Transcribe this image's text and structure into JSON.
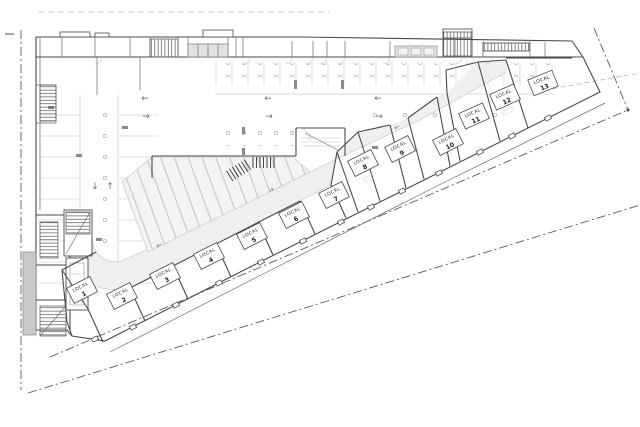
{
  "drawing": {
    "kind": "architectural-floor-plan",
    "units_label_word": "LOCAL"
  },
  "units": [
    {
      "name": "LOCAL",
      "number": "1"
    },
    {
      "name": "LOCAL",
      "number": "2"
    },
    {
      "name": "LOCAL",
      "number": "3"
    },
    {
      "name": "LOCAL",
      "number": "4"
    },
    {
      "name": "LOCAL",
      "number": "5"
    },
    {
      "name": "LOCAL",
      "number": "6"
    },
    {
      "name": "LOCAL",
      "number": "7"
    },
    {
      "name": "LOCAL",
      "number": "8"
    },
    {
      "name": "LOCAL",
      "number": "9"
    },
    {
      "name": "LOCAL",
      "number": "10"
    },
    {
      "name": "LOCAL",
      "number": "11"
    },
    {
      "name": "LOCAL",
      "number": "12"
    },
    {
      "name": "LOCAL",
      "number": "13"
    }
  ],
  "icons": {
    "arrow_left": "←",
    "arrow_right": "→",
    "arrow_up": "↑",
    "arrow_down": "↓"
  },
  "colors": {
    "wall": "#4a4a4a",
    "light_line": "#bdbdbd",
    "drive_lane_fill": "#efefef",
    "stall_fill": "#f3f3f3",
    "ramp_fill": "#c9c9c9",
    "boundary": "#5a5a5a",
    "background": "#ffffff"
  }
}
